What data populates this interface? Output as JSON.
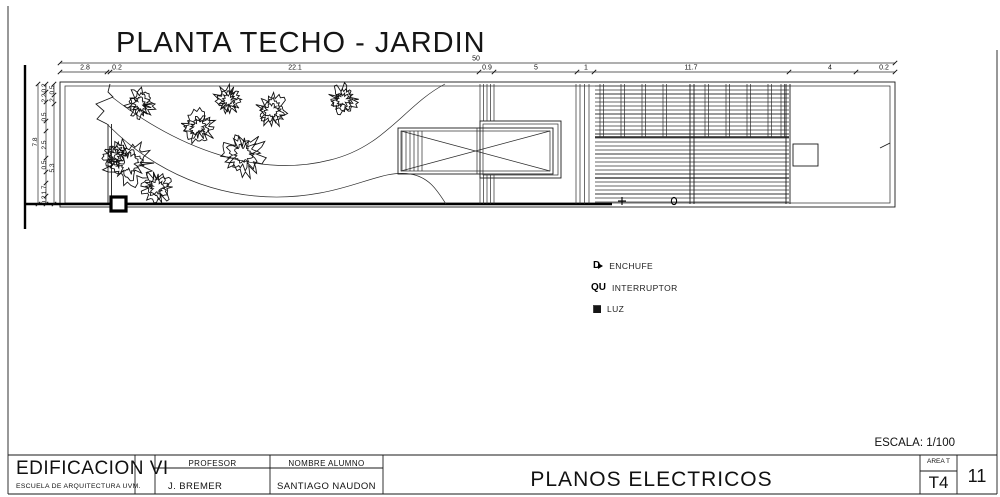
{
  "page_title": "PLANTA TECHO - JARDIN",
  "scale_note": "ESCALA: 1/100",
  "colors": {
    "ink": "#1a1a1a",
    "paper": "#ffffff",
    "hatch_gray": "#9a9a9a"
  },
  "legend": {
    "enchufe_glyph": "D",
    "interruptor_glyph": "QU",
    "items": [
      {
        "symbol": "enchufe-symbol",
        "label": "ENCHUFE"
      },
      {
        "symbol": "interruptor-symbol",
        "label": "INTERRUPTOR"
      },
      {
        "symbol": "luz-symbol",
        "label": "LUZ"
      }
    ]
  },
  "dimensions": {
    "overall_top": {
      "text": "50",
      "x": 476
    },
    "top": [
      {
        "text": "2.8",
        "x": 85
      },
      {
        "text": "0.2",
        "x": 117
      },
      {
        "text": "22.1",
        "x": 295
      },
      {
        "text": "0.9",
        "x": 487
      },
      {
        "text": "5",
        "x": 536
      },
      {
        "text": "1",
        "x": 586
      },
      {
        "text": "11.7",
        "x": 691
      },
      {
        "text": "4",
        "x": 830
      },
      {
        "text": "0.2",
        "x": 884
      }
    ],
    "left": [
      {
        "text": "0.2",
        "x": 46,
        "y": 88
      },
      {
        "text": "2.2",
        "x": 46,
        "y": 98
      },
      {
        "text": "0.5",
        "x": 54,
        "y": 90
      },
      {
        "text": "2",
        "x": 54,
        "y": 100
      },
      {
        "text": "0.5",
        "x": 46,
        "y": 117
      },
      {
        "text": "7.8",
        "x": 37,
        "y": 142
      },
      {
        "text": "2.5",
        "x": 46,
        "y": 145
      },
      {
        "text": "0.5",
        "x": 46,
        "y": 165
      },
      {
        "text": "5.3",
        "x": 54,
        "y": 168
      },
      {
        "text": "1.7",
        "x": 46,
        "y": 190
      },
      {
        "text": "0.2",
        "x": 46,
        "y": 200
      }
    ]
  },
  "title_block": {
    "project": "EDIFICACION VI",
    "school": "ESCUELA DE ARQUITECTURA UVM.",
    "professor_label": "PROFESOR",
    "professor": "J. BREMER",
    "student_label": "NOMBRE ALUMNO",
    "student": "SANTIAGO NAUDON",
    "sheet_title": "PLANOS ELECTRICOS",
    "area_label": "AREA T",
    "area": "T4",
    "sheet_number": "11"
  }
}
